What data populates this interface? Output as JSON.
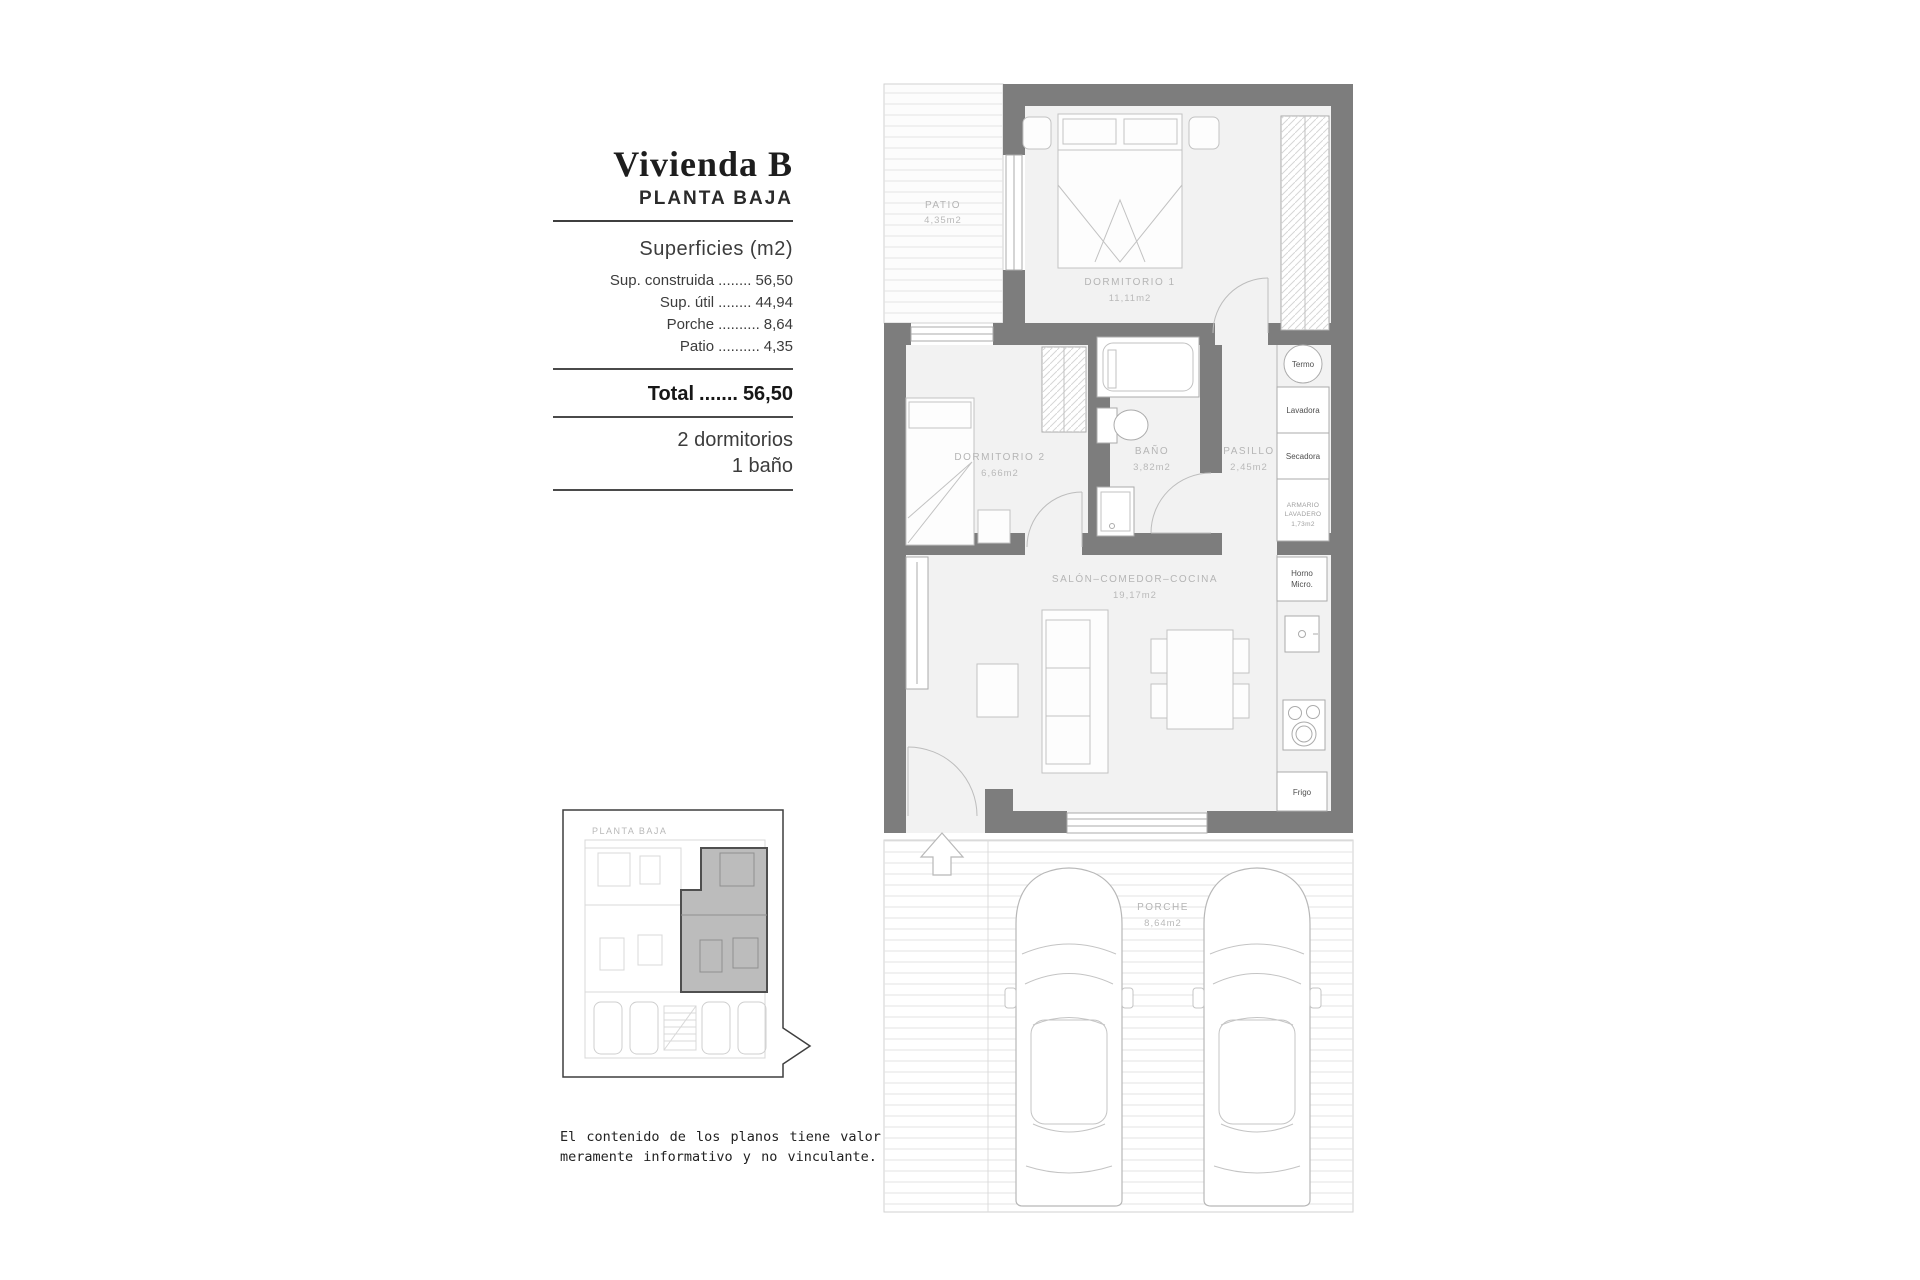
{
  "panel": {
    "title": "Vivienda B",
    "subtitle": "PLANTA BAJA",
    "surfaces_heading": "Superficies (m2)",
    "surfaces": [
      {
        "label": "Sup. construida",
        "dots": "........",
        "value": "56,50"
      },
      {
        "label": "Sup. útil",
        "dots": "........",
        "value": "44,94"
      },
      {
        "label": "Porche",
        "dots": "..........",
        "value": "8,64"
      },
      {
        "label": "Patio",
        "dots": "..........",
        "value": "4,35"
      }
    ],
    "total_label": "Total",
    "total_dots": ".......",
    "total_value": "56,50",
    "features": [
      "2 dormitorios",
      "1 baño"
    ]
  },
  "plan": {
    "rooms": {
      "patio": {
        "name": "PATIO",
        "area": "4,35m2"
      },
      "dormitorio1": {
        "name": "DORMITORIO 1",
        "area": "11,11m2"
      },
      "dormitorio2": {
        "name": "DORMITORIO 2",
        "area": "6,66m2"
      },
      "bano": {
        "name": "BAÑO",
        "area": "3,82m2"
      },
      "pasillo": {
        "name": "PASILLO",
        "area": "2,45m2"
      },
      "salon": {
        "name": "SALÓN–COMEDOR–COCINA",
        "area": "19,17m2"
      },
      "porche": {
        "name": "PORCHE",
        "area": "8,64m2"
      }
    },
    "appliances": {
      "termo": "Termo",
      "lavadora": "Lavadora",
      "secadora": "Secadora",
      "armario": [
        "ARMARIO",
        "LAVADERO",
        "1,73m2"
      ],
      "horno": [
        "Horno",
        "Micro."
      ],
      "frigo": "Frigo"
    }
  },
  "inset": {
    "label": "PLANTA BAJA"
  },
  "disclaimer": {
    "line1": "El contenido de los planos tiene valor",
    "line2": "meramente informativo y no vinculante."
  },
  "colors": {
    "wall": "#7d7d7d",
    "room_fill": "#f2f2f2",
    "hatch": "#e3e3e3",
    "label": "#b5b5b5"
  }
}
